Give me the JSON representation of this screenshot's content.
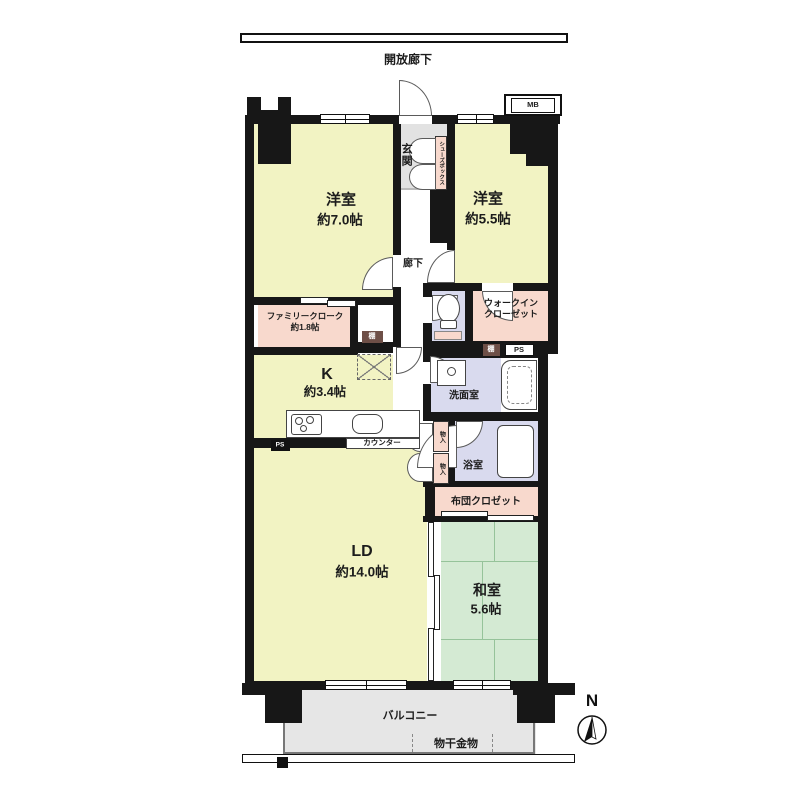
{
  "plan": {
    "open_corridor": "開放廊下",
    "mb": "MB",
    "genkan": "玄関",
    "shoebox": "シューズボックス",
    "room1_name": "洋室",
    "room1_size": "約7.0帖",
    "room2_name": "洋室",
    "room2_size": "約5.5帖",
    "hallway": "廊下",
    "family_cloak_name": "ファミリークローク",
    "family_cloak_size": "約1.8帖",
    "wic_line1": "ウォークイン",
    "wic_line2": "クローゼット",
    "shelf_kitchen": "棚",
    "shelf_washroom": "棚",
    "ps_washroom": "PS",
    "ps_kitchen": "PS",
    "kitchen_name": "K",
    "kitchen_size": "約3.4帖",
    "counter": "カウンター",
    "washroom": "洗面室",
    "storage1": "物入",
    "storage2": "物入",
    "bathroom": "浴室",
    "futon_closet": "布団クロゼット",
    "ld_name": "LD",
    "ld_size": "約14.0帖",
    "washitsu_name": "和室",
    "washitsu_size": "5.6帖",
    "balcony": "バルコニー",
    "laundry": "物干金物",
    "north": "N"
  },
  "colors": {
    "room_yellow": "#f2f3c3",
    "tatami_green": "#d4ead3",
    "closet_pink": "#f8d9cd",
    "wet_lavender": "#d9daee",
    "entry_gray": "#e2e2e2",
    "wall_black": "#171717",
    "shelf_dark": "#6e4f47"
  }
}
